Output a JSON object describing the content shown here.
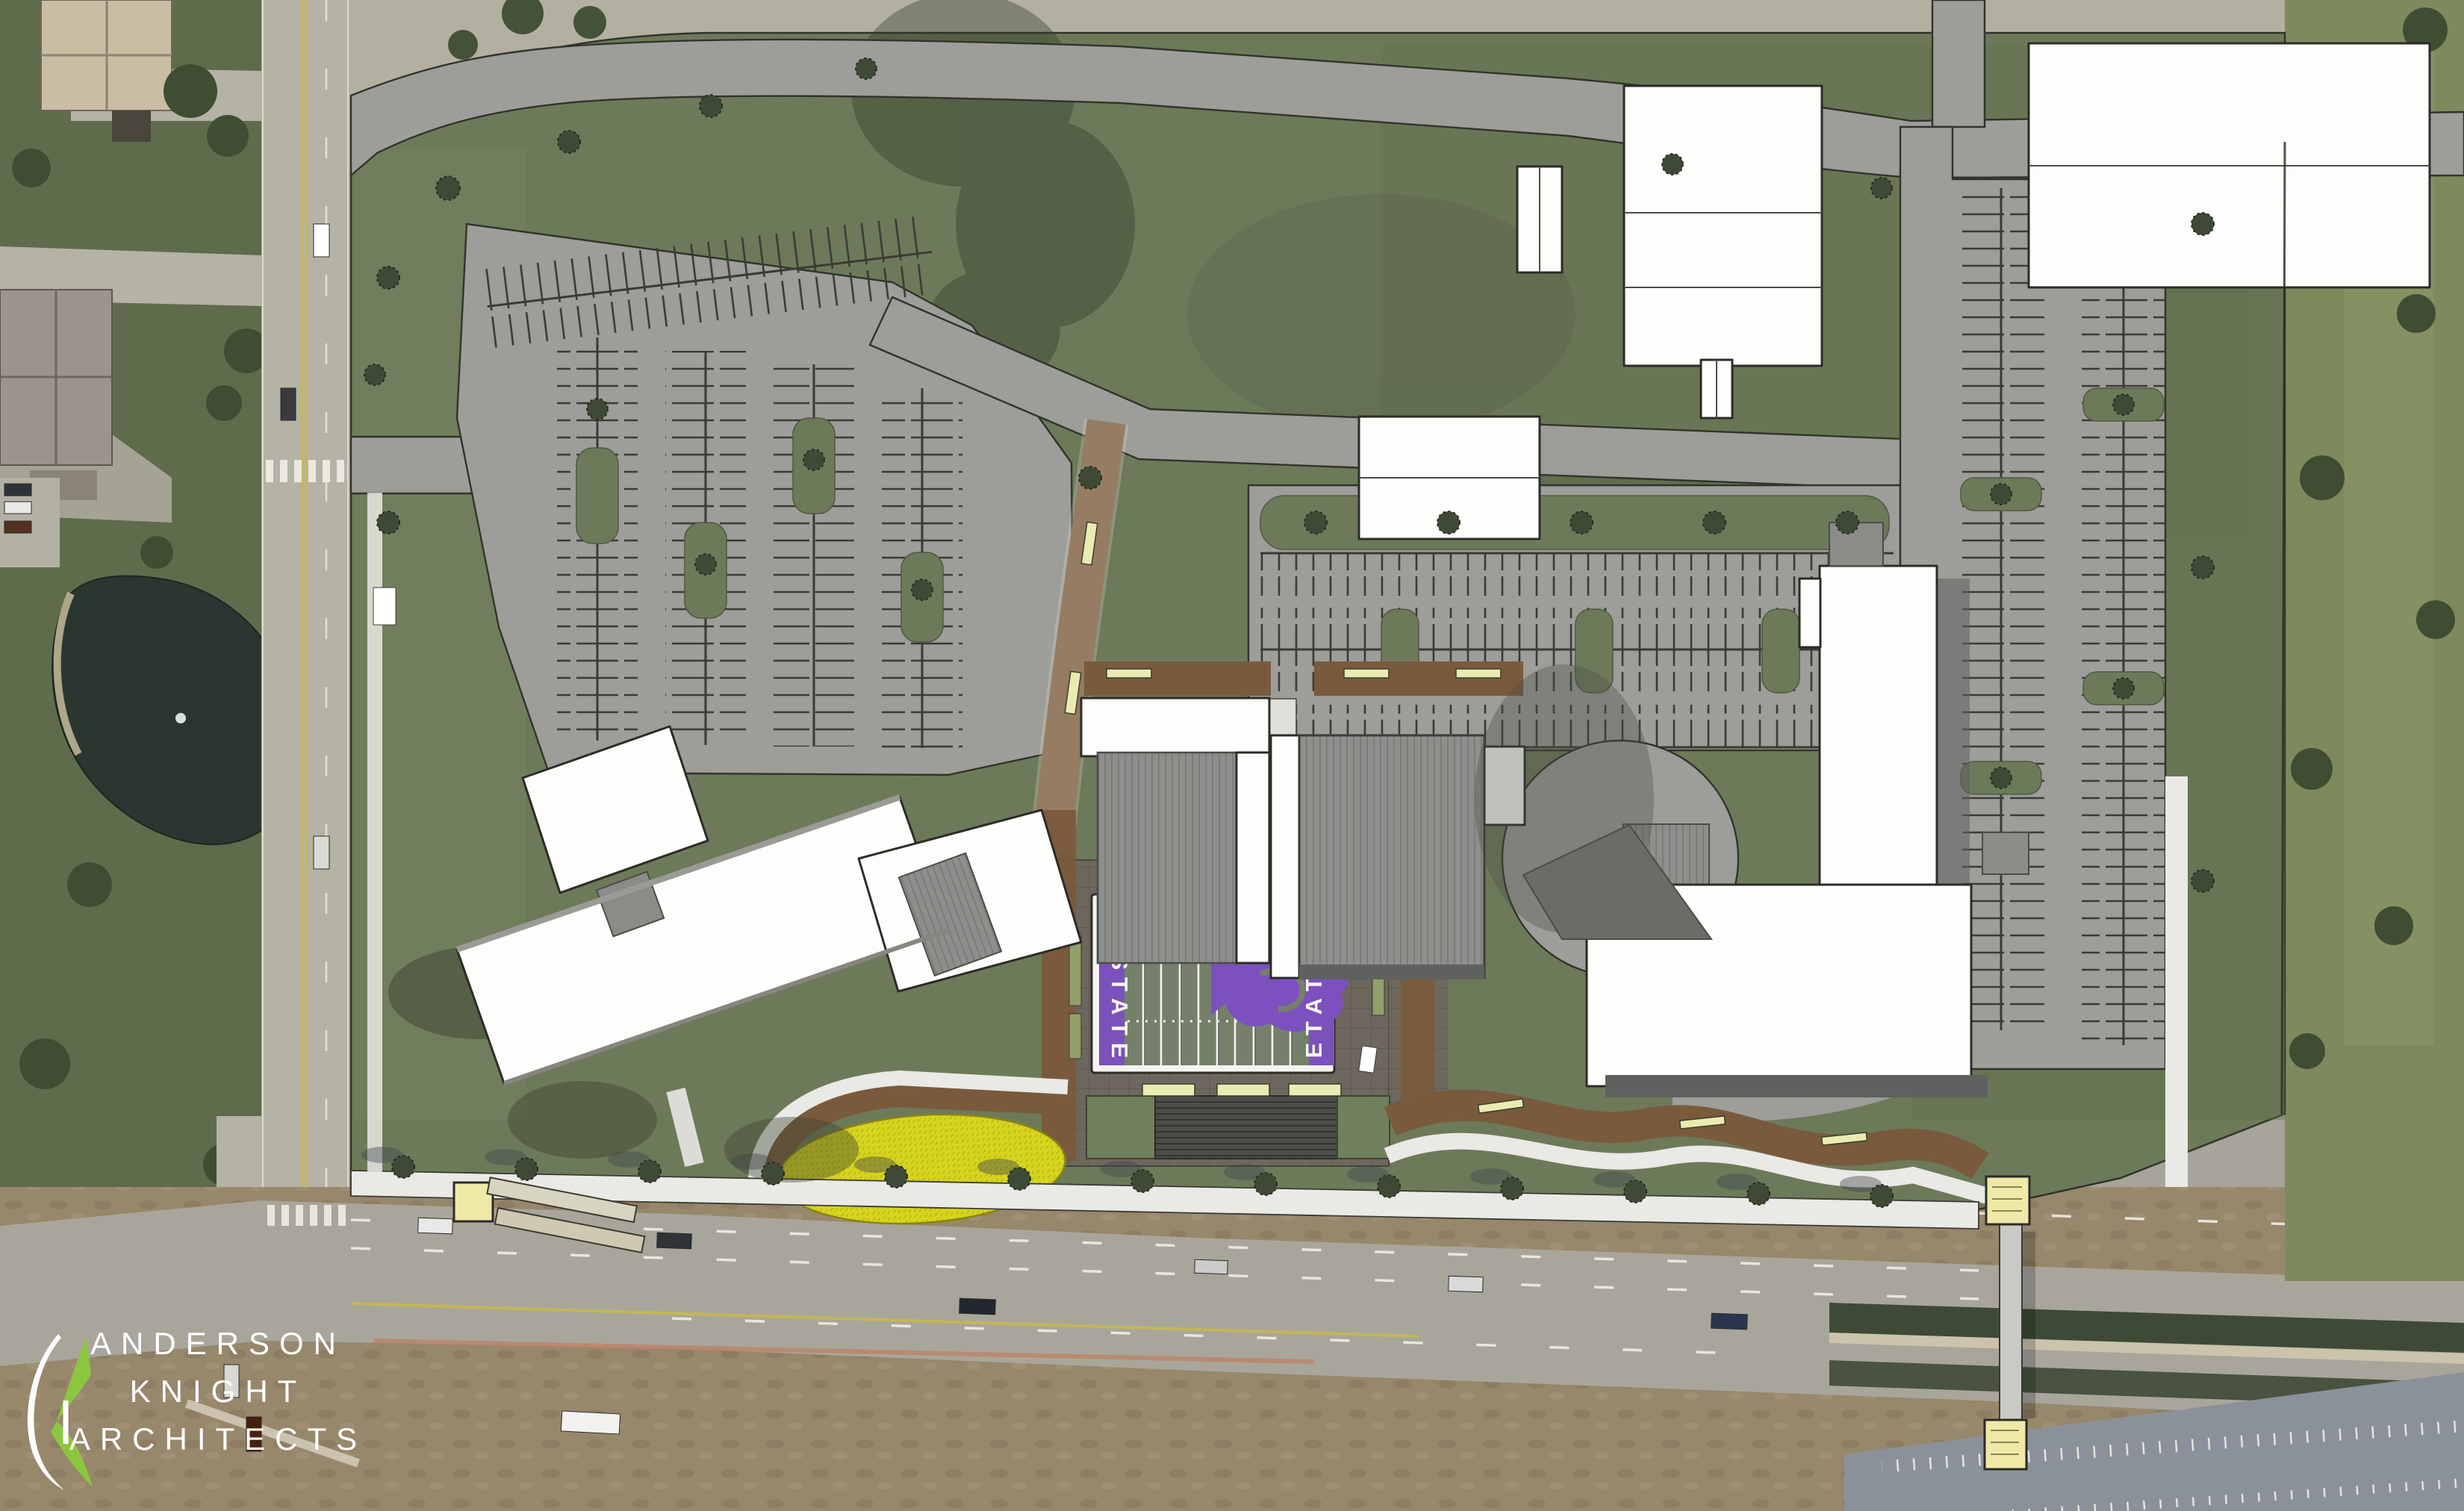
{
  "branding": {
    "firm_lines": [
      "ANDERSON",
      "KNIGHT",
      "ARCHITECTS"
    ],
    "text_color": "#ffffff",
    "accent_green": "#8cc63f"
  },
  "field": {
    "endzone_text": "K-STATE",
    "colors": {
      "endzone_purple": "#7b51bb",
      "turf_green": "#75806a",
      "border_white": "#f4f4ef",
      "logo_purple": "#7d50bf"
    }
  },
  "site_colors": {
    "lawn_green": "#6d7a5a",
    "parking_gray": "#9d9d99",
    "plaza_taupe": "#6e675e",
    "promenade_brown": "#7a5a3c",
    "flower_bed_yellow": "#d6d41e",
    "building_white": "#fdfdfb",
    "roof_gray": "#8d8f8c",
    "tower_yellow": "#efe9a8",
    "sidewalk_white": "#e9e9e5",
    "shadow_green": "#39422f"
  },
  "aerial_colors": {
    "pavement": "#b5b2a6",
    "grass": "#5f6c4c",
    "trees": "#3f4d33",
    "pond": "#2c3631",
    "dirt": "#97876b",
    "median_green": "#3e4a35",
    "south_lot_gray": "#8b919b",
    "lane_yellow": "#c8b84a",
    "painted_stripe_red": "#bf7f63",
    "highway_gray": "#a8a69b"
  },
  "icons": {
    "powercat": "wildcat-silhouette",
    "monogram": "ak-crescent-mark",
    "tree": "scribble-circle"
  }
}
